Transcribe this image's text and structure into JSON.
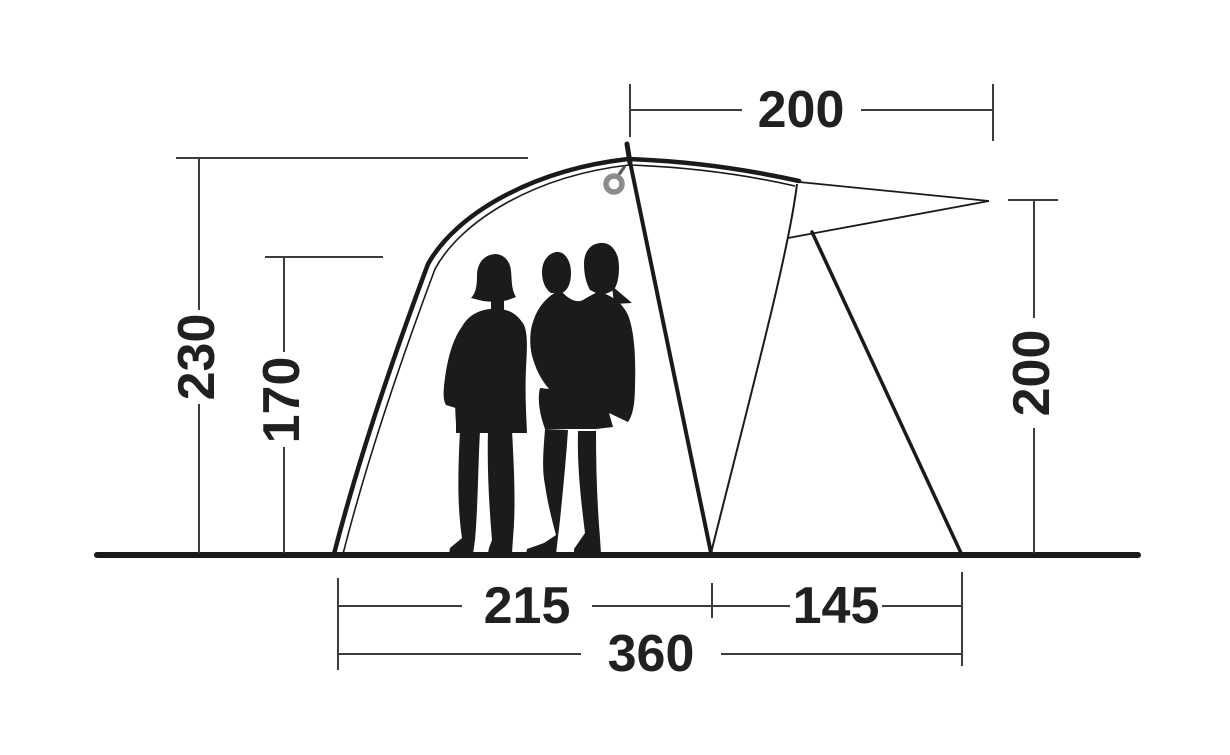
{
  "diagram": {
    "type": "tent-side-profile-dimension-diagram",
    "labels": {
      "top_width": "200",
      "left_height": "230",
      "standing_height": "170",
      "canopy_height": "200",
      "floor_front": "215",
      "floor_porch": "145",
      "floor_total": "360"
    },
    "colors": {
      "outline": "#1a1a1a",
      "dimension_line": "#3c3c3c",
      "text": "#221f1f",
      "ring": "#8c8c8c",
      "silhouette": "#1b1b1b",
      "background": "#ffffff"
    }
  }
}
